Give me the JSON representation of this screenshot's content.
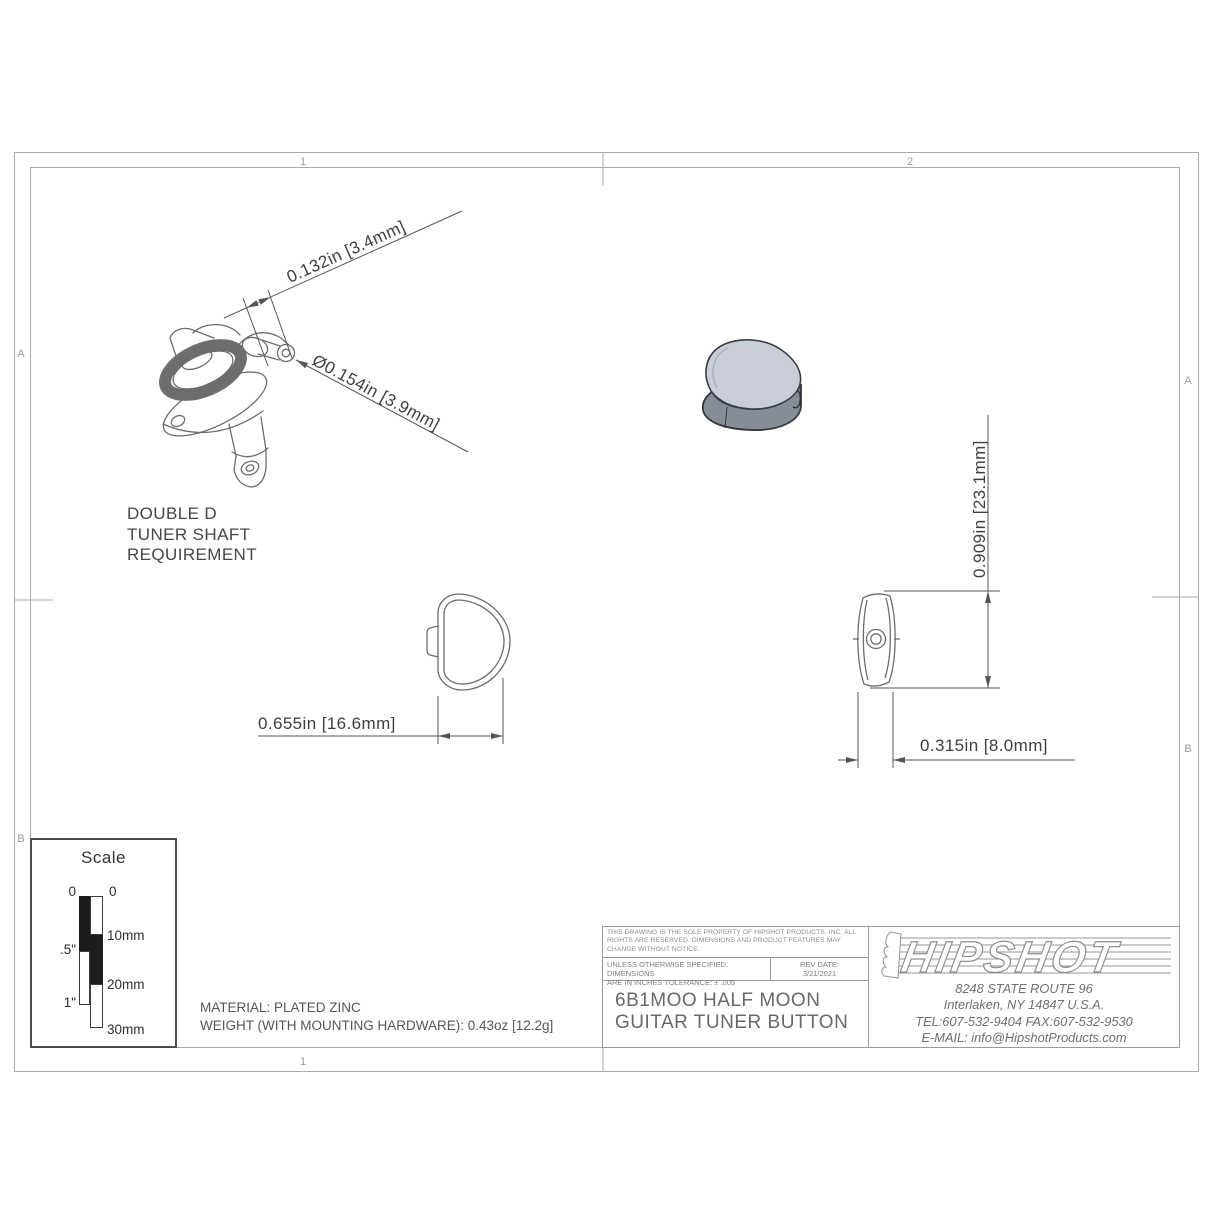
{
  "drawing": {
    "kind": "engineering-drawing",
    "zones": {
      "top_left": "1",
      "top_right": "2",
      "bottom": "1",
      "left_a": "A",
      "left_b": "B",
      "right_a": "A",
      "right_b": "B"
    },
    "dimensions": {
      "shaft_flat_width": "0.132in [3.4mm]",
      "shaft_diameter": "Ø0.154in [3.9mm]",
      "button_length": "0.909in [23.1mm]",
      "button_width": "0.655in [16.6mm]",
      "button_thickness": "0.315in [8.0mm]"
    },
    "shaft_note": "DOUBLE D\nTUNER SHAFT\nREQUIREMENT",
    "notes": {
      "material": "MATERIAL: PLATED ZINC",
      "weight": "WEIGHT (WITH MOUNTING HARDWARE): 0.43oz [12.2g]"
    },
    "scale_box": {
      "title": "Scale",
      "inch_0": "0",
      "inch_half": ".5\"",
      "inch_1": "1\"",
      "mm_0": "0",
      "mm_10": "10mm",
      "mm_20": "20mm",
      "mm_30": "30mm"
    },
    "title_block": {
      "legal": "THIS DRAWING IS THE SOLE PROPERTY OF HIPSHOT PRODUCTS, INC. ALL RIGHTS ARE RESERVED. DIMENSIONS AND PRODUCT FEATURES MAY CHANGE WITHOUT NOTICE.",
      "spec": "UNLESS OTHERWISE SPECIFIED: DIMENSIONS\nARE IN INCHES TOLERANCE:  ± .005",
      "rev": "REV DATE:\n3/21/2021",
      "part_title": "6B1MOO HALF MOON\nGUITAR TUNER BUTTON",
      "company": {
        "logo_text": "HIPSHOT",
        "address1": "8248 STATE ROUTE 96",
        "address2": "Interlaken, NY 14847 U.S.A.",
        "phone": "TEL:607-532-9404 FAX:607-532-9530",
        "email": "E-MAIL: info@HipshotProducts.com"
      }
    },
    "colors": {
      "line": "#6d6d6d",
      "dim_line": "#555555",
      "dim_text": "#3f3f3f",
      "frame": "#ababab",
      "iso_top": "#c8cdd7",
      "iso_side": "#878d96"
    }
  }
}
